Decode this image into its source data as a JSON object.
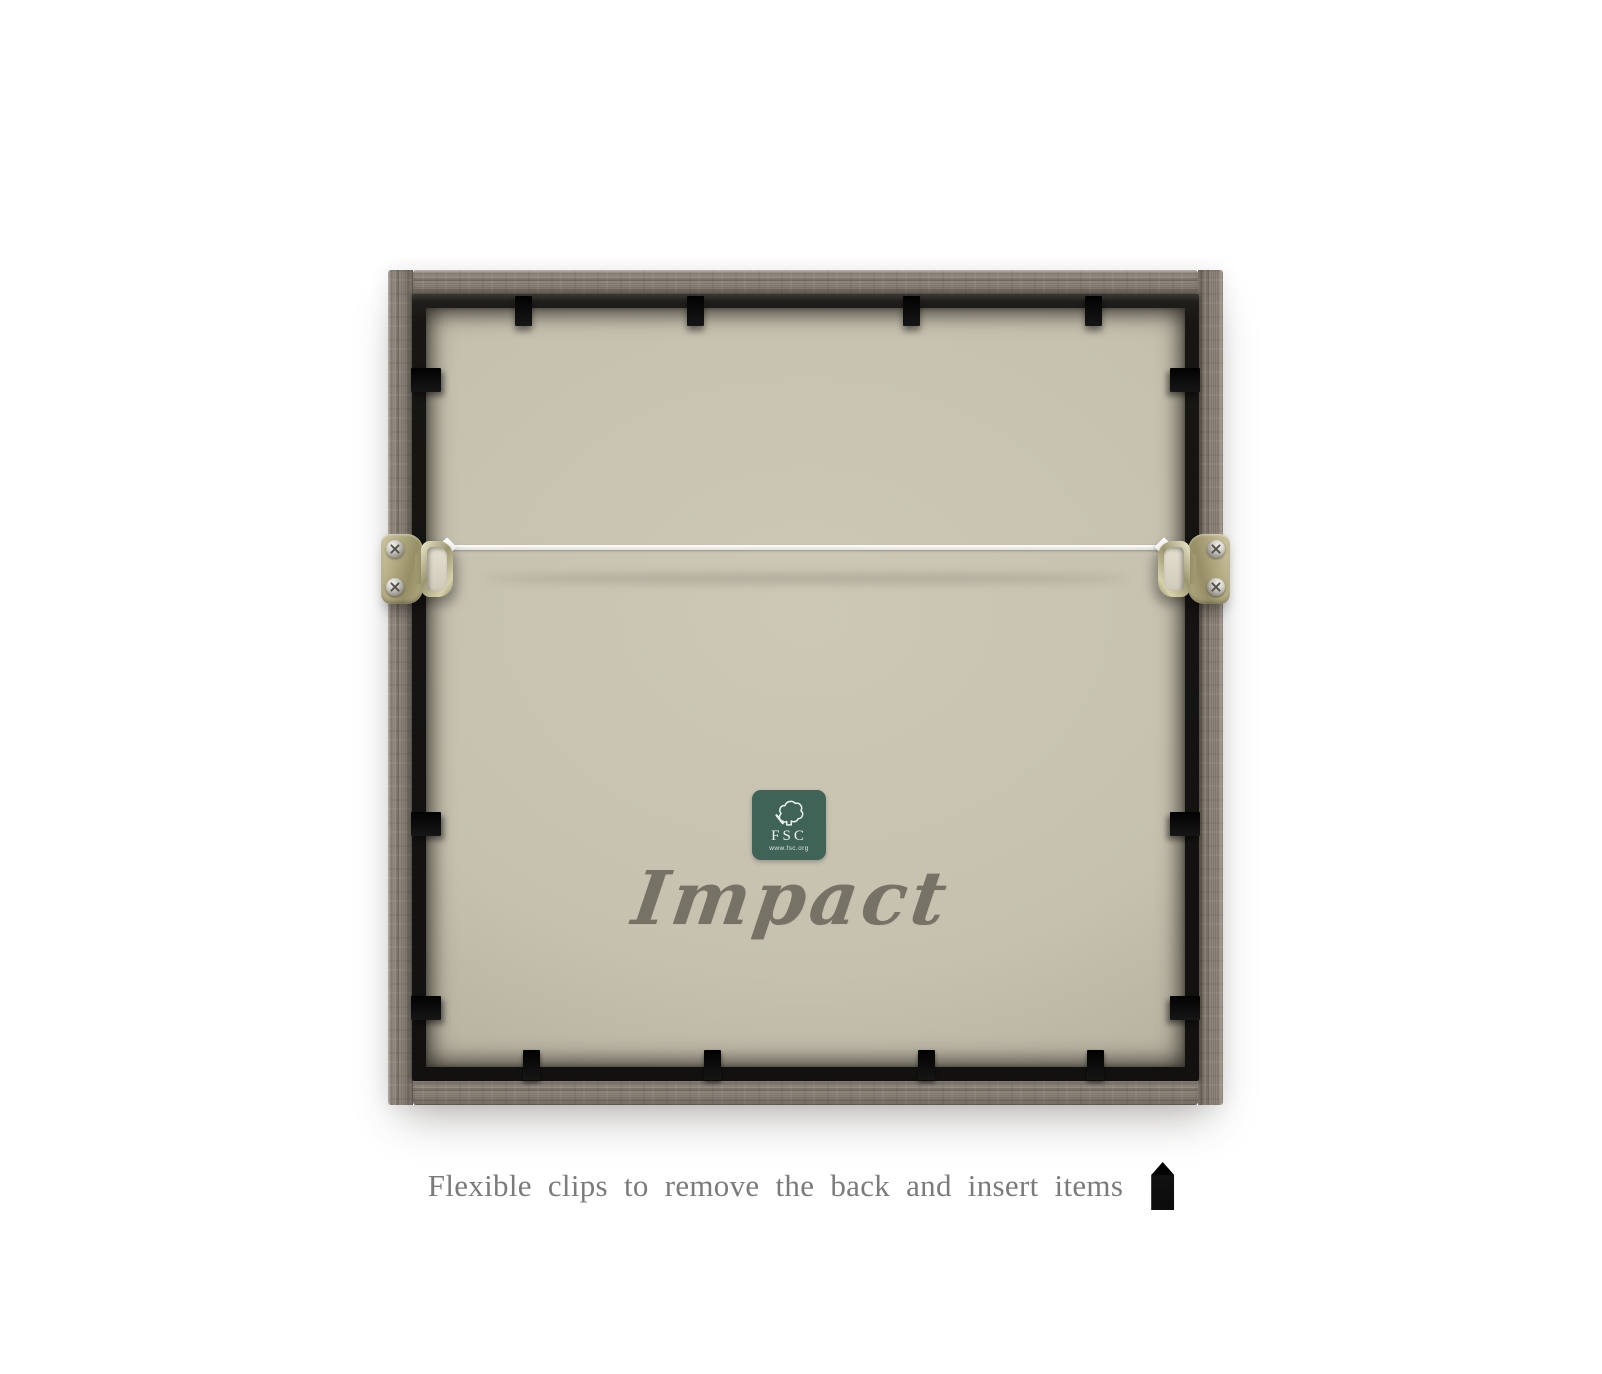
{
  "frame_back": {
    "brand_logo_text": "Impact",
    "fsc_label": {
      "acronym": "FSC",
      "website": "www.fsc.org"
    }
  },
  "caption": {
    "text": "Flexible clips to remove the back and insert items"
  },
  "colors": {
    "background": "#ffffff",
    "wood": "#8b8177",
    "black_frame": "#171613",
    "backing_board": "#c6c1af",
    "fsc_green": "#3f6356",
    "wire": "#ffffff",
    "caption_text": "#7b7b7b",
    "brand_logo": "#6c675c"
  },
  "icons": {
    "fsc_tree": "fsc-tree-icon",
    "flexible_clip": "flexible-clip-icon",
    "screws": "screw-icon",
    "d_ring": "d-ring-hanger"
  }
}
